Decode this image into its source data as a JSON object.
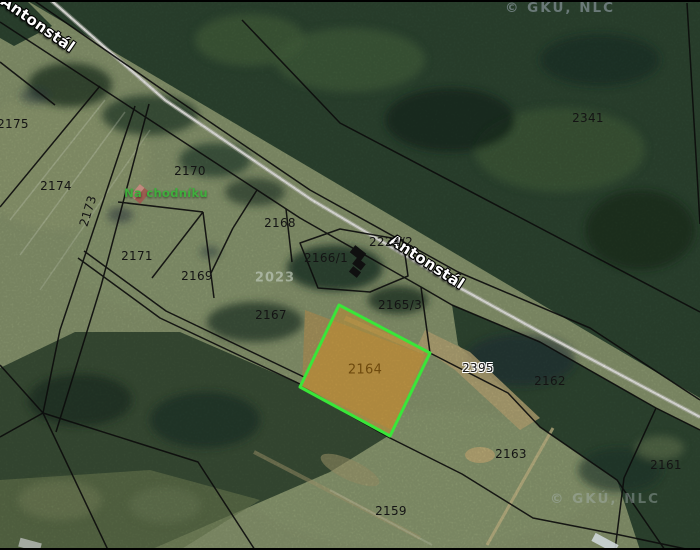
{
  "map": {
    "attribution": "© GKÚ, NLC",
    "road": {
      "name": "Antonstál"
    },
    "place": {
      "name": "Na chodníku",
      "color": "#3fae3c"
    },
    "faded_overlay": {
      "text": "2023"
    },
    "selected_parcel": {
      "number": "2164",
      "outline_color": "#39e639",
      "fill_color": "rgba(203,141,38,0.45)",
      "label_color": "#6e4a0e"
    },
    "parcels": {
      "p2175": {
        "number": "2175"
      },
      "p2174": {
        "number": "2174"
      },
      "p2173": {
        "number": "2173"
      },
      "p2170": {
        "number": "2170"
      },
      "p2171": {
        "number": "2171"
      },
      "p2169": {
        "number": "2169"
      },
      "p2168": {
        "number": "2168"
      },
      "p2166_1": {
        "number": "2166/1"
      },
      "p2167": {
        "number": "2167"
      },
      "p2165_3": {
        "number": "2165/3"
      },
      "p2224_2": {
        "number": "2224/2"
      },
      "p2395": {
        "number": "2395"
      },
      "p2341": {
        "number": "2341"
      },
      "p2162": {
        "number": "2162"
      },
      "p2163": {
        "number": "2163"
      },
      "p2161": {
        "number": "2161"
      },
      "p2159": {
        "number": "2159"
      }
    }
  }
}
